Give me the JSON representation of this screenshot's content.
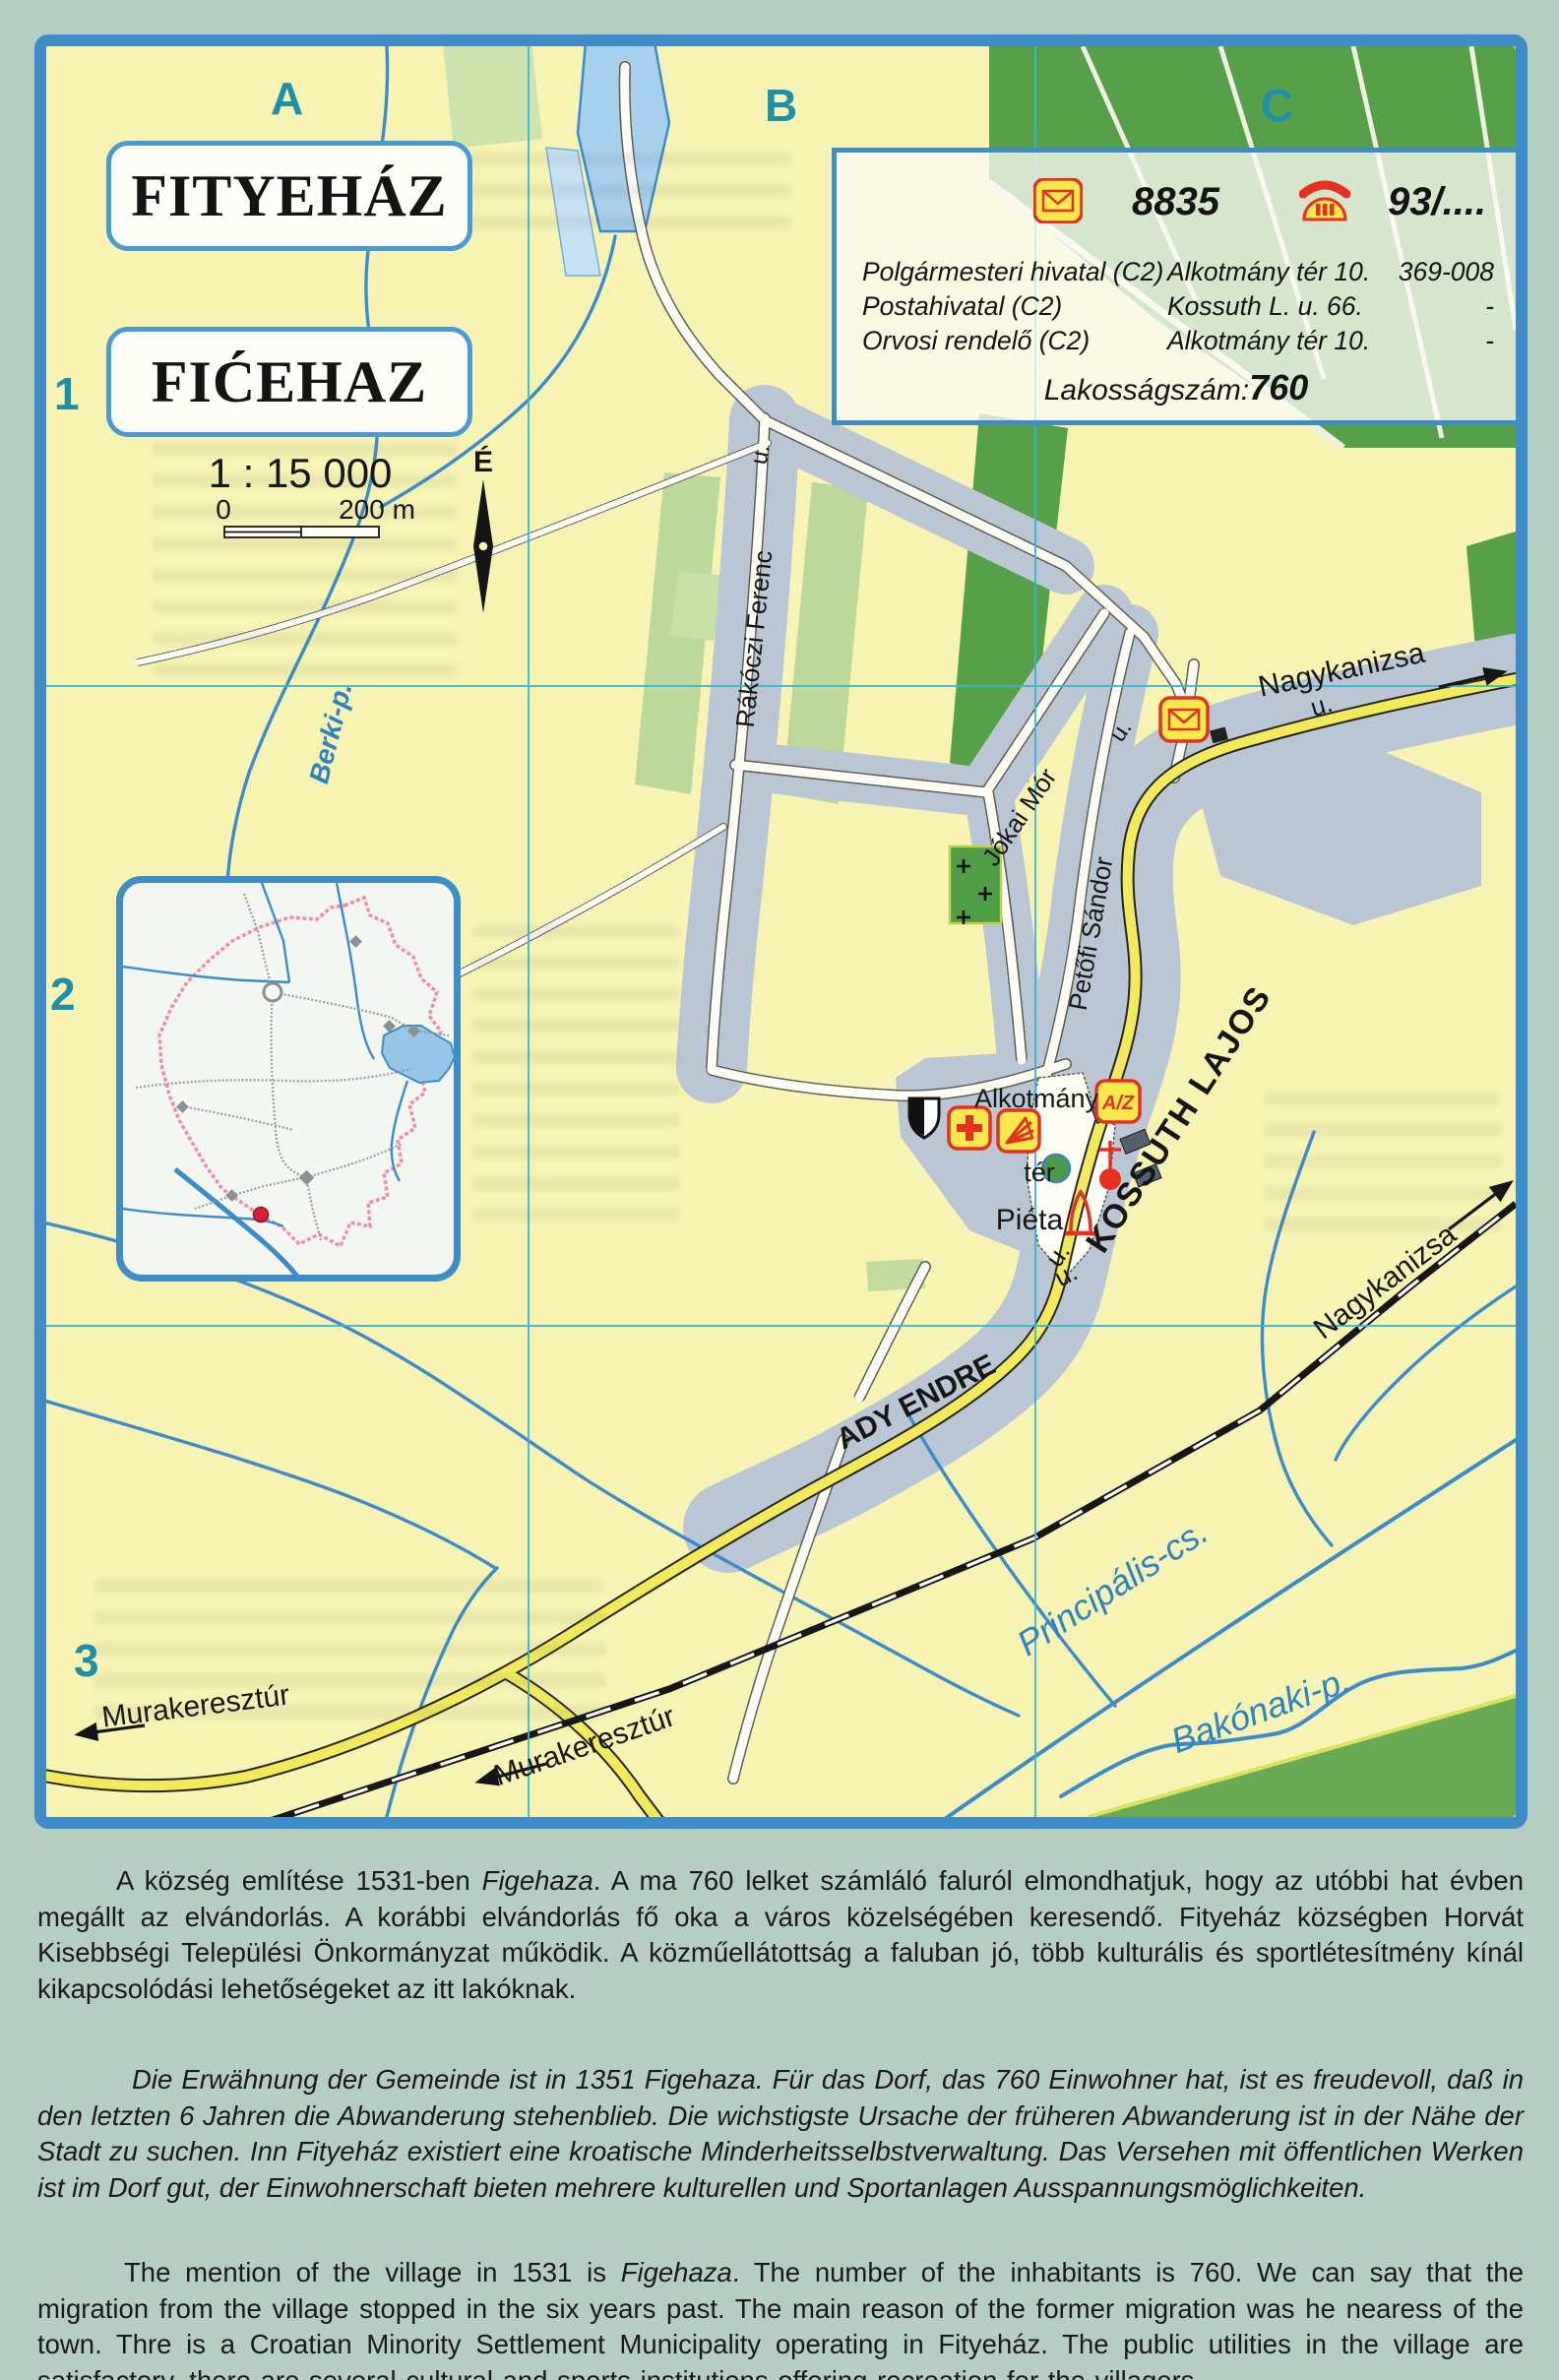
{
  "grid": {
    "columns": [
      "A",
      "B",
      "C"
    ],
    "rows": [
      "1",
      "2",
      "3"
    ]
  },
  "titles": {
    "hungarian": "FITYEHÁZ",
    "croatian": "FIĆEHAZ"
  },
  "scale": {
    "ratio": "1 : 15 000",
    "start": "0",
    "end": "200 m",
    "north": "É"
  },
  "info_box": {
    "postal_code": "8835",
    "phone_code": "93/....",
    "entries": [
      {
        "name": "Polgármesteri hivatal (C2)",
        "address": "Alkotmány tér 10.",
        "phone": "369-008"
      },
      {
        "name": "Postahivatal (C2)",
        "address": "Kossuth L. u. 66.",
        "phone": "-"
      },
      {
        "name": "Orvosi rendelő (C2)",
        "address": "Alkotmány tér 10.",
        "phone": "-"
      }
    ],
    "population_label": "Lakosságszám:",
    "population": "760"
  },
  "map_labels": {
    "rakoczi": "Rákóczi Ferenc",
    "rakoczi_u": "u.",
    "jokai": "Jókai Mór",
    "jokai_u": "u.",
    "petofi": "Petőfi Sándor",
    "kossuth": "KOSSUTH LAJOS",
    "kossuth_u": "u.",
    "ady": "ADY ENDRE",
    "ady_u": "u.",
    "nagykanizsa_road": "Nagykanizsa",
    "nagykanizsa_road_u": "u.",
    "nagykanizsa_rail": "Nagykanizsa",
    "murakeresztur_road": "Murakeresztúr",
    "murakeresztur_rail": "Murakeresztúr",
    "berki": "Berki-p.",
    "principalis": "Principális-cs.",
    "bakonaki": "Bakónaki-p.",
    "alkotmany": "Alkotmány",
    "ter": "tér",
    "pieta": "Piéta",
    "az_sign": "A/Z"
  },
  "colors": {
    "page_background": "#b6cdc3",
    "map_background": "#f7f3b2",
    "frame_blue": "#3e8cc8",
    "grid_teal": "#1f90a8",
    "grid_line_cyan": "#3ab5d5",
    "forest_green": "#55a048",
    "field_green": "#bcd89a",
    "built_up_gray": "#bac6d4",
    "main_road_yellow": "#f3ea5b",
    "water_blue": "#3c8ccd",
    "icon_red": "#e53022",
    "icon_yellow": "#f9e94c",
    "boundary_pink": "#ee8fae"
  },
  "paragraphs": [
    {
      "id": "hu",
      "segments": [
        {
          "t": "A község említése 1531-ben "
        },
        {
          "t": "Figehaza",
          "i": true
        },
        {
          "t": ". A ma 760 lelket számláló faluról elmondhatjuk, hogy az utóbbi hat évben megállt az elvándorlás. A korábbi elvándorlás fő oka a város közelségében keresendő. Fityeház községben Horvát Kisebbségi Települési Önkormányzat működik. A közműellátottság a faluban jó, több kulturális és sportlétesítmény kínál kikapcsolódási lehetőségeket az itt lakóknak."
        }
      ]
    },
    {
      "id": "de",
      "segments": [
        {
          "t": "Die Erwähnung der Gemeinde ist in 1351 Figehaza.  Für das Dorf, das 760 Einwohner hat, ist es freudevoll, daß in den letzten 6 Jahren die Abwanderung stehenblieb. Die wichstigste Ursache der früheren Abwanderung ist in der Nähe der Stadt zu suchen. Inn Fityeház existiert eine kroatische Minderheitsselbstverwaltung. Das Versehen mit öffentlichen Werken ist im Dorf gut, der Einwohnerschaft bieten mehrere kulturellen und Sportanlagen Ausspannungsmöglichkeiten."
        }
      ]
    },
    {
      "id": "en",
      "segments": [
        {
          "t": "The mention of the village in 1531 is "
        },
        {
          "t": "Figehaza",
          "i": true
        },
        {
          "t": ". The number of the inhabitants is 760. We can say that the migration from the village stopped in the six years past. The main reason of the former migration was he nearess of the town. Thre is a Croatian Minority Settlement Municipality operating in Fityeház. The public utilities in the village are satisfactory, there are several cultural and sports institutions offering recreation for the villagers."
        }
      ]
    }
  ]
}
